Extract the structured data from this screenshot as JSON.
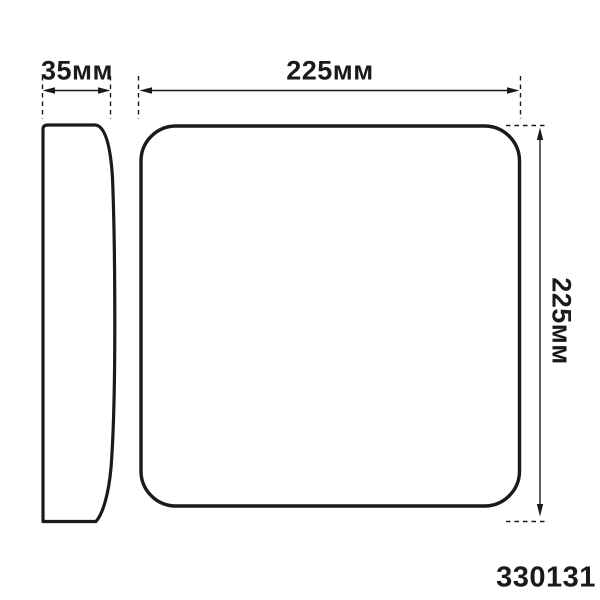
{
  "drawing": {
    "type": "product-dimension-diagram",
    "views": {
      "side": {
        "name": "side-profile-view",
        "width_dim": "35мм"
      },
      "front": {
        "name": "front-view",
        "width_dim": "225мм",
        "height_dim": "225мм"
      }
    },
    "part_number": "330131",
    "colors": {
      "line": "#1a1a1a",
      "background": "#ffffff"
    }
  }
}
